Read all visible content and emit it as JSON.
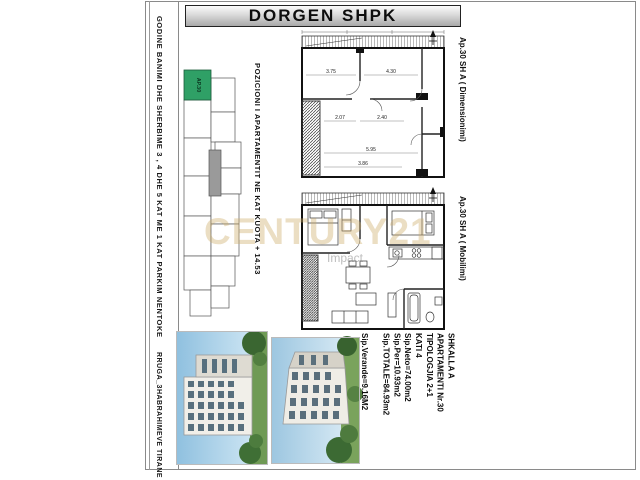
{
  "title": "DORGEN SHPK",
  "left_strip": {
    "building_text": "GODINE BANIMI DHE SHERBIME 3 , 4 DHE 5 KAT ME 1 KAT PARKIM NENTOKE",
    "street_text": "RRUGA_3HABRAHIMEVE  TIRANE"
  },
  "key_plan": {
    "highlight_label": "AP.30",
    "highlight_color": "#2fa066"
  },
  "position_label": "POZICIONI I APARTAMENTIT NE KAT KUOTA + 14.53",
  "plans": {
    "dimensional": {
      "side_label": "Ap.30 SH A ( Dimensionimi)",
      "dims": [
        "3.75",
        "4.30",
        "2.07",
        "2.40",
        "5.95",
        "3.86"
      ]
    },
    "furnished": {
      "side_label": "Ap.30 SH A ( Mobilimi)"
    }
  },
  "details": {
    "staircase": "SHKALLA A",
    "apartment": "APARTAMENTI  Nr.30",
    "typology": "TIPOLOGJIA  2+1",
    "floor": "KATI 4",
    "net_area": "Sip.Neto=74.00m2",
    "per_area": "Sip.Per=10.93m2",
    "total_area": "Sip.TOTALE=84.93m2",
    "veranda_area": "Sip.Verande=9.16M2"
  },
  "watermark": {
    "text": "CENTURY21",
    "subtext": "Impact"
  }
}
